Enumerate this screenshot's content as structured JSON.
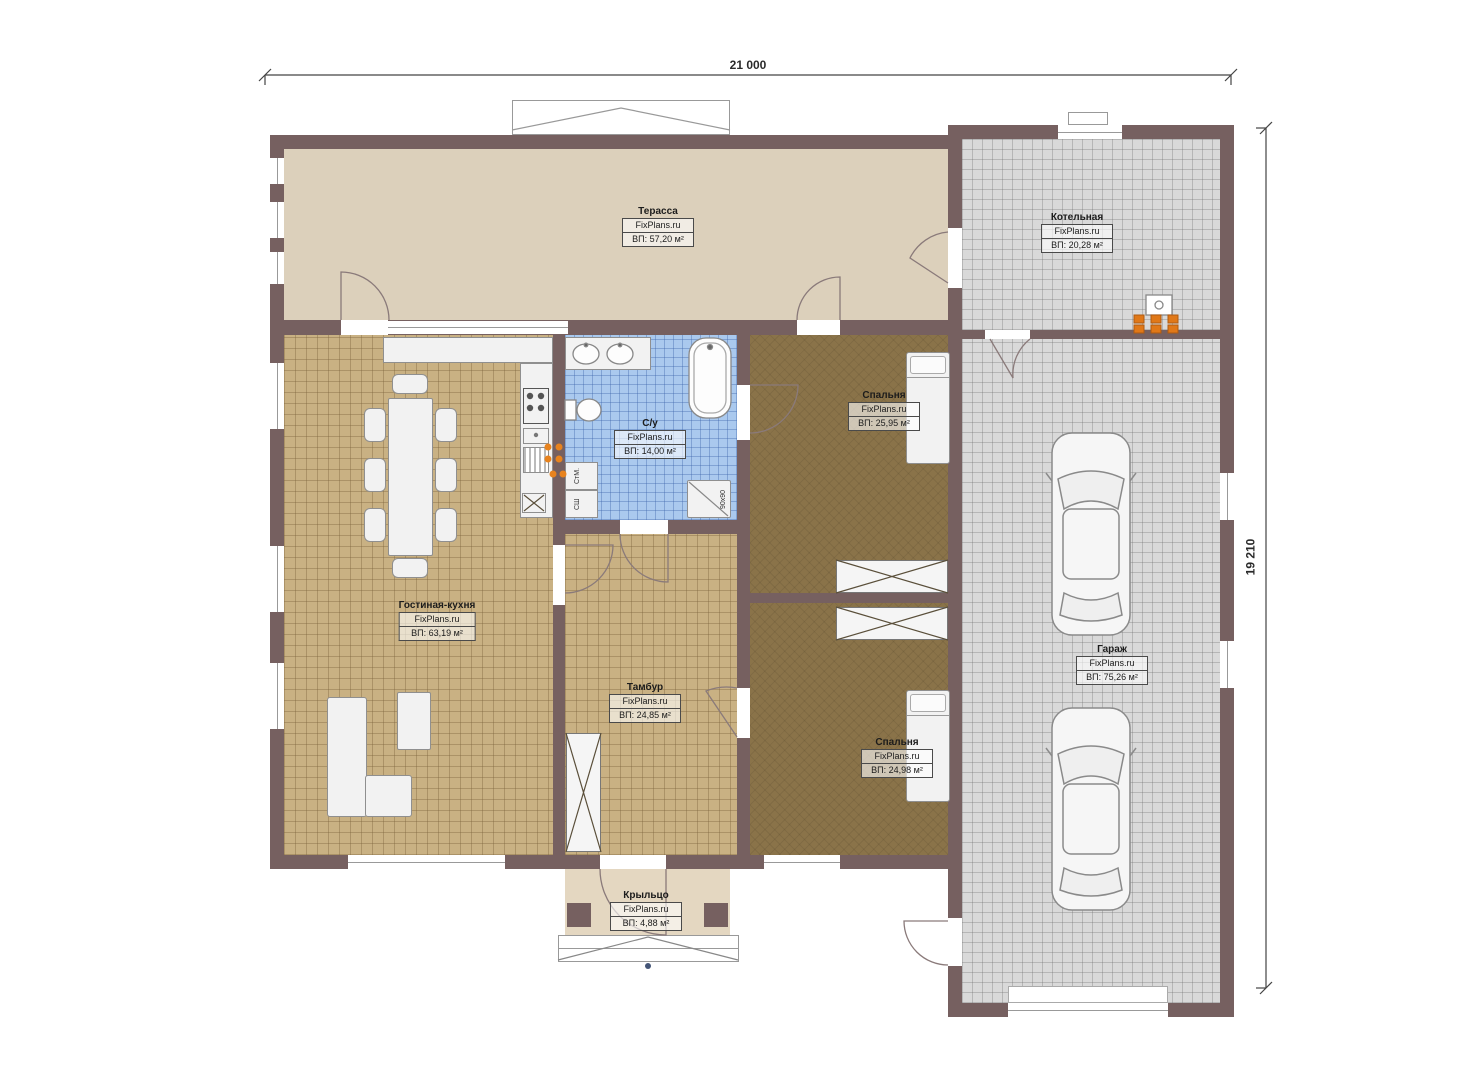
{
  "watermark": "FixPlans.ru",
  "dimensions": {
    "width_top": "21 000",
    "height_right": "19 210"
  },
  "rooms": [
    {
      "name": "Терасса",
      "area": "ВП: 57,20 м²"
    },
    {
      "name": "Котельная",
      "area": "ВП: 20,28 м²"
    },
    {
      "name": "С/у",
      "area": "ВП: 14,00 м²"
    },
    {
      "name": "Спальня",
      "area": "ВП: 25,95 м²"
    },
    {
      "name": "Гостиная-кухня",
      "area": "ВП: 63,19 м²"
    },
    {
      "name": "Тамбур",
      "area": "ВП: 24,85 м²"
    },
    {
      "name": "Спальня",
      "area": "ВП: 24,98 м²"
    },
    {
      "name": "Гараж",
      "area": "ВП: 75,26 м²"
    },
    {
      "name": "Крыльцо",
      "area": "ВП: 4,88 м²"
    }
  ],
  "annotations": {
    "washing_machine": "СтМ.",
    "drying_cabinet": "СШ",
    "shower_size": "90x90"
  },
  "colors": {
    "wall": "#766060",
    "terrace_floor": "#dcd0bb",
    "tile_tan": "#c9b183",
    "tile_blue": "#aac9ee",
    "tile_gray": "#d9d9d9",
    "bedroom_floor": "#8a7349",
    "accent_orange": "#e07818"
  }
}
